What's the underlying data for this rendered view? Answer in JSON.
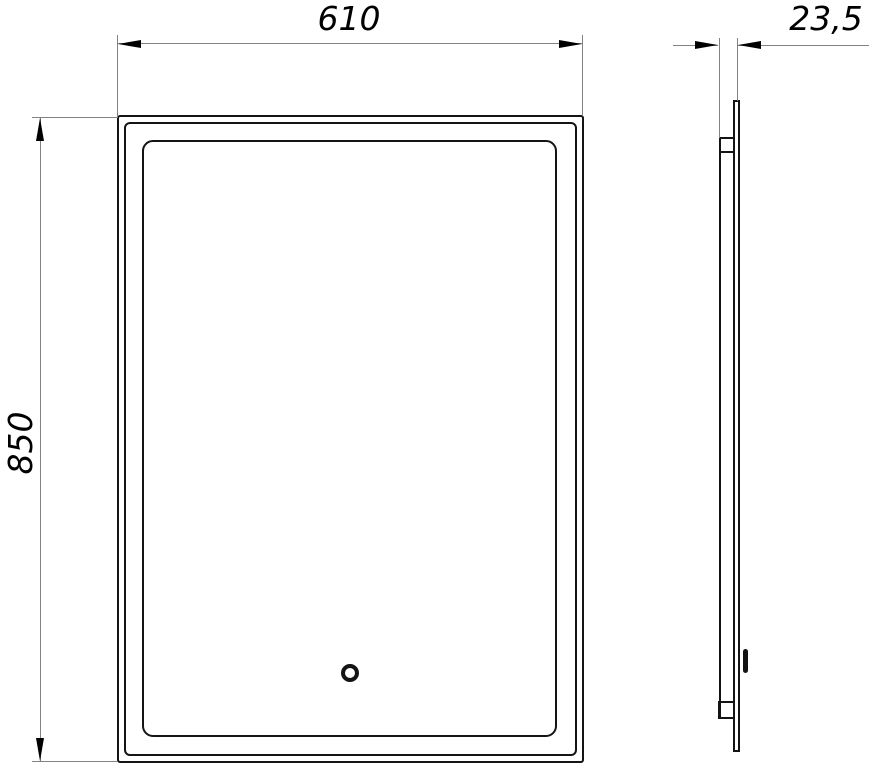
{
  "drawing": {
    "type": "technical-dimension-drawing",
    "subject": "illuminated mirror with touch sensor, front view and side profile view",
    "dimensions": {
      "width": {
        "label": "610"
      },
      "height": {
        "label": "850"
      },
      "depth": {
        "label": "23,5"
      }
    },
    "colors": {
      "object_line": "#141414",
      "dimension_line": "#828282",
      "arrow_and_text": "#000000",
      "background": "#ffffff"
    }
  }
}
